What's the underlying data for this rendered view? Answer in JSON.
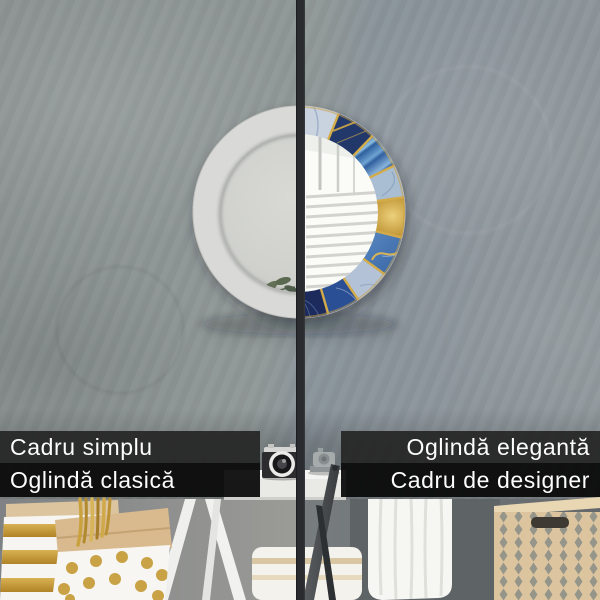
{
  "comparison": {
    "left_panel": {
      "line1": "Cadru simplu",
      "line2": "Oglindă clasică"
    },
    "right_panel": {
      "line1": "Oglindă elegantă",
      "line2": "Cadru de designer"
    }
  },
  "colors": {
    "label_bar_primary": "#262626",
    "label_bar_secondary": "#0a0a0a",
    "label_text": "#fdfdfd",
    "divider": "#292c2e",
    "wall_gray": "#8c9496",
    "frame_left_white": "#d9d9d7",
    "frame_right_navy": "#20396b",
    "frame_right_blue": "#4374b2",
    "frame_right_gold": "#c59b3d",
    "basket_beige": "#dcc49f"
  }
}
